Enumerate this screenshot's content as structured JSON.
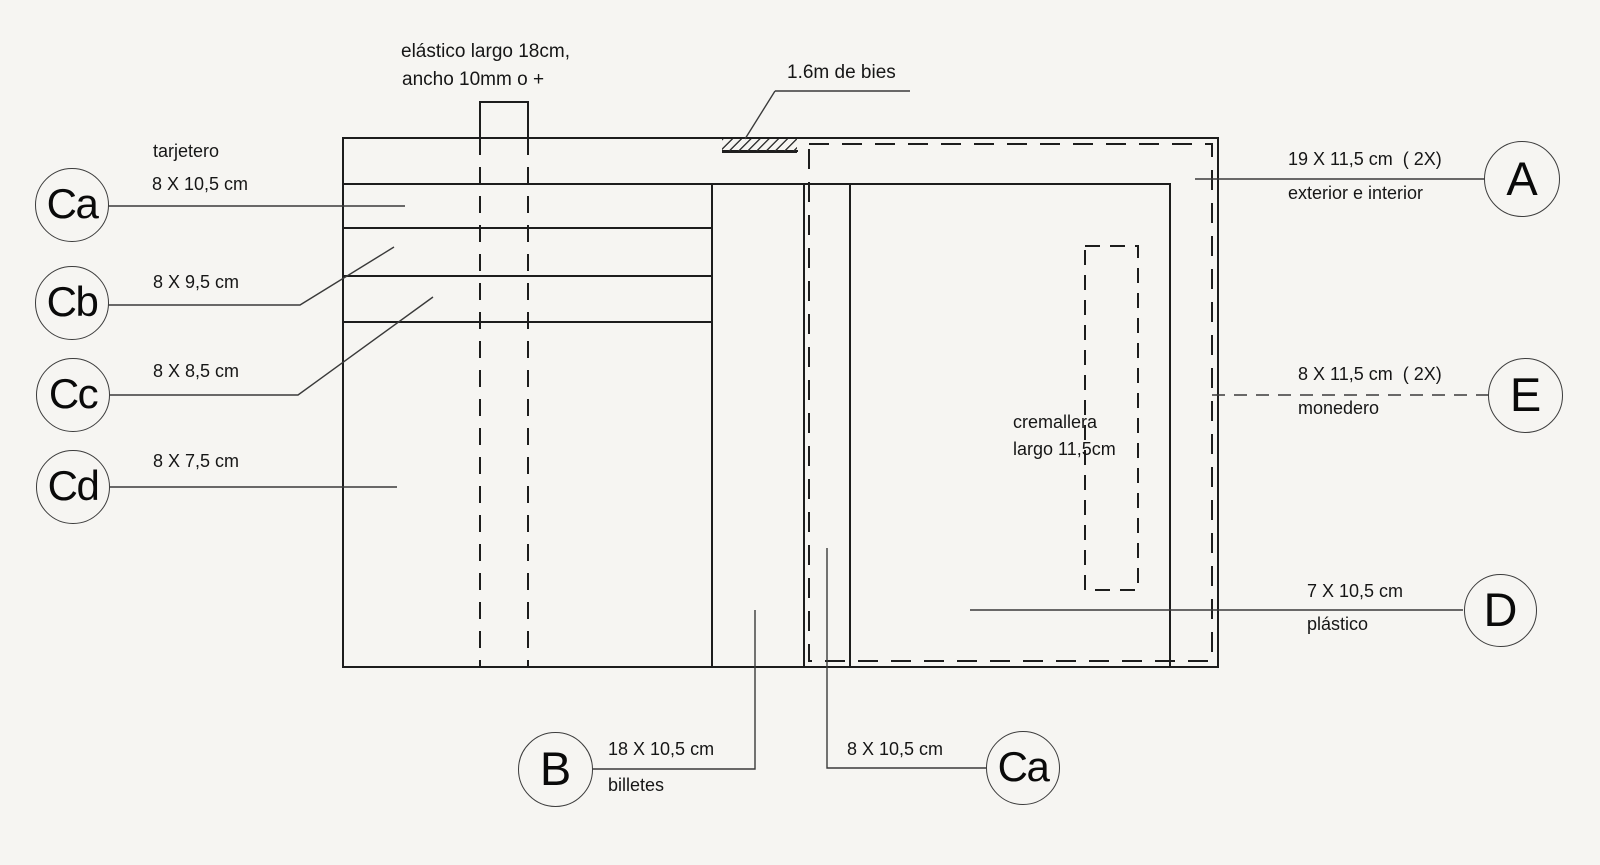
{
  "page": {
    "background_color": "#f6f5f2",
    "line_color": "#1d1d1d",
    "leader_color": "#3a3a3a"
  },
  "annotations": {
    "elastic_line1": "elástico largo 18cm,",
    "elastic_line2": "ancho 10mm o +",
    "bies": "1.6m de bies",
    "zipper_line1": "cremallera",
    "zipper_line2": "largo 11,5cm"
  },
  "callouts": {
    "ca": {
      "letter": "Ca",
      "note": "tarjetero",
      "dim": "8 X 10,5 cm"
    },
    "cb": {
      "letter": "Cb",
      "dim": "8 X 9,5 cm"
    },
    "cc": {
      "letter": "Cc",
      "dim": "8 X 8,5 cm"
    },
    "cd": {
      "letter": "Cd",
      "dim": "8 X 7,5 cm"
    },
    "b": {
      "letter": "B",
      "dim": "18 X 10,5 cm",
      "note": "billetes"
    },
    "ca_bottom": {
      "letter": "Ca",
      "dim": "8 X 10,5 cm"
    },
    "a": {
      "letter": "A",
      "dim": "19 X 11,5 cm  ( 2X)",
      "note": "exterior e interior"
    },
    "e": {
      "letter": "E",
      "dim": "8 X 11,5 cm  ( 2X)",
      "note": "monedero"
    },
    "d": {
      "letter": "D",
      "dim": "7 X 10,5 cm",
      "note": "plástico"
    }
  }
}
